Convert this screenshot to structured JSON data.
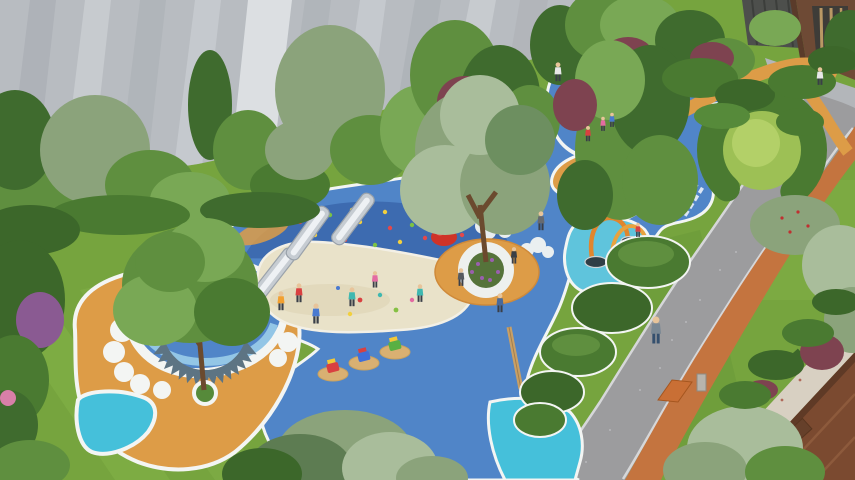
{
  "scene": {
    "type": "aerial-architectural-rendering",
    "subject": "children-playground-courtyard",
    "elements": [
      "residential-tower-facade",
      "tree-canopies",
      "terraced-lawn",
      "grey-footpath",
      "blue-rubber-playground-surface",
      "climbing-slope-with-holds",
      "stainless-steel-slides",
      "sand-pit",
      "central-tree-planter-bench",
      "serrated-seat-ring-lagoon",
      "cloud-motif-borders",
      "orange-play-mound",
      "boat-sculpture",
      "rainbow-steps",
      "hopscotch-grid",
      "court-markings",
      "water-play-channel",
      "balance-beam",
      "spring-riders",
      "ladybug-sculptures",
      "tomato-sculpture",
      "hedge-ring",
      "winding-orange-path",
      "jogging-track",
      "pedestrian-road",
      "paved-walkway",
      "townhouse-roof",
      "entrance-lobby",
      "visitors"
    ]
  },
  "palette": {
    "lawn": "#76a43e",
    "lawn_light": "#8ab84c",
    "lawn_dark": "#5c8c33",
    "lawn_mound": "#9dc055",
    "hedge": "#4a7a31",
    "hedge_dark": "#3c672a",
    "foliage_mid": "#5f8f3f",
    "foliage_light": "#79a855",
    "foliage_grey": "#8ba37b",
    "foliage_pale": "#a9bd9b",
    "foliage_dark": "#3f6b2e",
    "shrub_maroon": "#7e4350",
    "shrub_purple": "#8a5a92",
    "blue_main": "#5085c8",
    "blue_deep": "#3d6bb0",
    "blue_light": "#93c6e6",
    "cyan_water": "#5fc4dc",
    "cyan_patch": "#45c0da",
    "sand": "#e9e2c9",
    "sand_shadow": "#d9cfae",
    "orange_pad": "#dd9c47",
    "orange_deep": "#cf8a3a",
    "track_orange": "#c4743f",
    "white_border": "#f3f5f3",
    "road_grey": "#9c9c9e",
    "road_curb": "#d6d7d9",
    "path_grey": "#bcbfc3",
    "facade_grey": "#b8bcc1",
    "facade_light": "#d5d9dd",
    "facade_shadow": "#a5aab0",
    "plaza_grey": "#b3b6ba",
    "brown_building": "#6e4a35",
    "brown_roof": "#7b4a30",
    "roof_shadow": "#5f3a26",
    "walkway": "#d8d0c2",
    "glass_dark": "#3e3c38",
    "glass_warm": "#c8a369",
    "metal": "#c6ccd2",
    "metal_dark": "#9aa2aa",
    "seat_teeth": "#5d7483",
    "ladybug_red": "#c92f23",
    "ladybug_dark": "#33302c",
    "tomato_red": "#cf3328",
    "trunk": "#6b4a2e",
    "skin": "#e8c49a",
    "hold_red": "#e4484a",
    "hold_yellow": "#f2d03e",
    "hold_green": "#7dc243",
    "rainbow_pink": "#e46ba2",
    "rainbow_purple": "#9a6cc8",
    "rainbow_orange": "#f0a030",
    "rainbow_teal": "#3fb8b0",
    "rainbow_green": "#85c043"
  }
}
